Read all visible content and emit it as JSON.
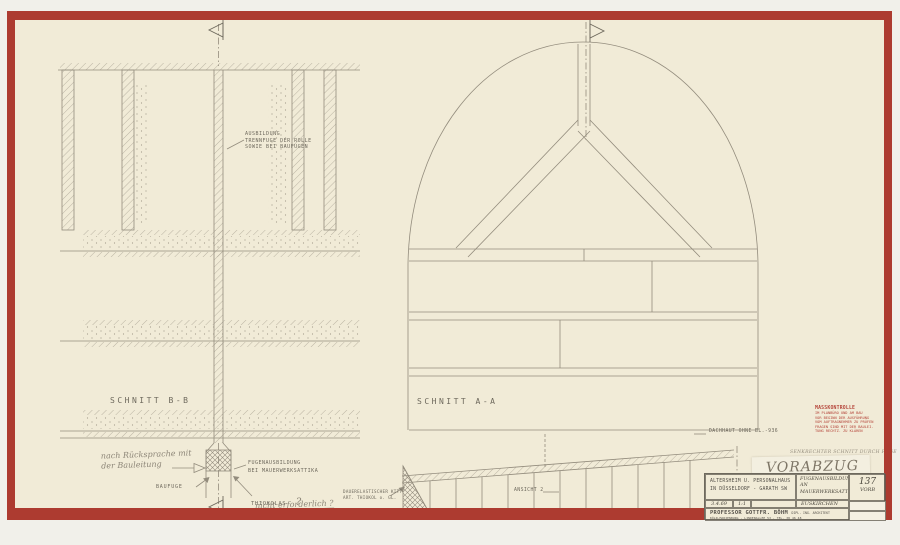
{
  "colors": {
    "paper": "#f1ebd7",
    "border_red": "#ad3b30",
    "pencil": "#938c7d",
    "typed_text": "#6e695d",
    "stamp_red": "#b5453a"
  },
  "left_drawing": {
    "title": "SCHNITT B-B",
    "joint_note": "AUSBILDUNG\nTRENNFUGE DER ROLLE\nSOWIE BEI BAUFUGEN",
    "bauleitung_note": "nach Rücksprache mit\nder Bauleitung",
    "baufuge_label": "BAUFUGE",
    "fugen_note": "FUGENAUSBILDUNG\nBEI MAUERWERKSATTIKA",
    "thiokol_label": "THIOKOLAS",
    "thiokol_q": "?",
    "not_required_note": "nicht erforderlich ?",
    "kitt_note": "DAUERELASTISCHER KITT\nART. THIOKOL o. GL."
  },
  "right_drawing": {
    "title": "SCHNITT A-A",
    "dachhaut_label": "DACHHAUT OHNE BL.-936",
    "ansicht_label": "ANSICHT 2"
  },
  "stamp": {
    "title": "MASSKONTROLLE",
    "body": "IM PLANBÜRO UND AM BAU\nVOR BEGINN DER AUSFÜHRUNG\nVOM AUFTRAGNEHMER ZU PRÜFEN\nFRAGEN SIND MIT DER BAULEI-\nTUNG RECHTZ. ZU KLÄREN"
  },
  "notes": {
    "schnitt_note": "SENKRECHTER SCHNITT DURCH FUGE",
    "vorabzug": "VORABZUG !"
  },
  "title_block": {
    "project_line1": "ALTERSHEIM U. PERSONALHAUS",
    "project_line2": "IN DÜSSELDORF - GARATH  SW",
    "subject": "FUGENAUSBILDUNG\nAN\nMAUERWERKSATTIKA",
    "location": "EUSKIRCHEN",
    "sheet_no": "137",
    "sheet_sub": "VORB",
    "date": "3.4.69",
    "scale": "1:1",
    "architect": "PROFESSOR GOTTFR. BÖHM",
    "architect_sub": "DIPL. ING. ARCHITEKT",
    "architect_addr": "KÖLN-MARIENBURG · LINDENALLEE 53 · TEL. 38 46 48"
  }
}
